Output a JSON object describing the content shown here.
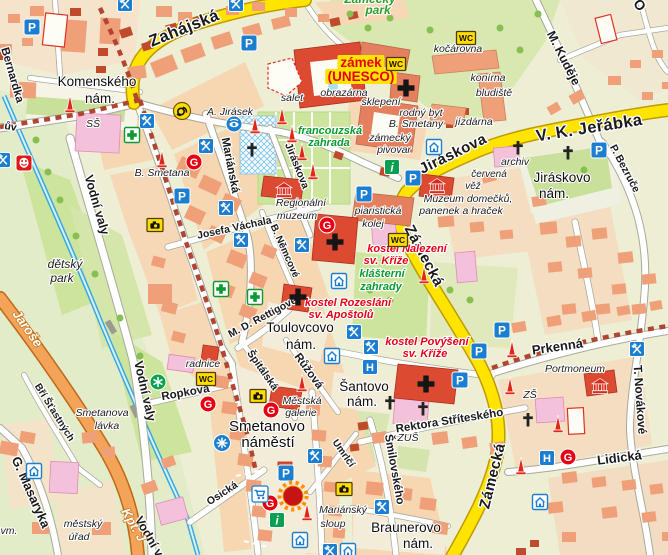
{
  "map": {
    "colors": {
      "land": "#edeed4",
      "park": "#cde49c",
      "park_bright": "#c9e09a",
      "square": "#f3ecd9",
      "block": "#f7d6b2",
      "block_pale": "#f4ddc0",
      "building": "#efa078",
      "building_dark": "#e5805e",
      "brick": "#bf4a2c",
      "landmark_red": "#dc4a32",
      "school_pink": "#f3c1d9",
      "road_major": "#ffe400",
      "road_major_casing": "#c09a00",
      "road_secondary": "#f4a458",
      "road_secondary_casing": "#c06818",
      "road_minor": "#ffffff",
      "road_minor_casing": "#a8a89c",
      "water": "#38a8e0",
      "historic_zone": "#b04632",
      "poi_blue": "#1b7ed0",
      "poi_red": "#e60012",
      "poi_green": "#0aa050",
      "poi_yellow": "#ffdc00",
      "castle_highlight": "#ffe400"
    },
    "icon_kinds": {
      "parking": {
        "name": "parking-icon",
        "glyph": "P"
      },
      "wc": {
        "name": "wc-icon",
        "glyph": "WC"
      },
      "restaurant": {
        "name": "restaurant-icon"
      },
      "pharmacy": {
        "name": "pharmacy-icon"
      },
      "hotel": {
        "name": "hotel-icon",
        "glyph": "H"
      },
      "pension": {
        "name": "guesthouse-icon"
      },
      "info": {
        "name": "information-icon",
        "glyph": "i"
      },
      "post": {
        "name": "post-office-icon"
      },
      "museum": {
        "name": "museum-icon"
      },
      "theater": {
        "name": "theatre-icon"
      },
      "gallery": {
        "name": "gallery-icon",
        "glyph": "G"
      },
      "monument": {
        "name": "monument-icon"
      },
      "church": {
        "name": "church-icon"
      },
      "cross": {
        "name": "cross-icon"
      },
      "camera": {
        "name": "camera-icon"
      },
      "star": {
        "name": "star-icon"
      },
      "fountain": {
        "name": "fountain-icon"
      },
      "cart": {
        "name": "supermarket-icon"
      },
      "sight": {
        "name": "sight-eye-icon"
      },
      "highlight": {
        "name": "landmark-highlight-icon"
      }
    },
    "labels": [
      {
        "t": "Zahájská",
        "x": 186,
        "y": 33,
        "r": -22,
        "c": "sm"
      },
      {
        "t": "V. K. Jeřábka",
        "x": 590,
        "y": 133,
        "r": -9,
        "c": "sm"
      },
      {
        "t": "Jiráskova",
        "x": 455,
        "y": 158,
        "r": -26,
        "c": "sm",
        "s": 15
      },
      {
        "t": "Zámecká",
        "x": 420,
        "y": 258,
        "r": 62,
        "c": "sm",
        "s": 15
      },
      {
        "t": "Zámecká",
        "x": 497,
        "y": 477,
        "r": -76,
        "c": "sm",
        "s": 15
      },
      {
        "t": "M. Kuděje",
        "x": 560,
        "y": 60,
        "r": 63,
        "c": "st",
        "s": 12.5
      },
      {
        "t": "P. Bezruče",
        "x": 622,
        "y": 170,
        "r": 62,
        "c": "st",
        "s": 10.5
      },
      {
        "t": "Mariánská",
        "x": 227,
        "y": 166,
        "r": 79,
        "c": "st"
      },
      {
        "t": "Jiráskova",
        "x": 294,
        "y": 167,
        "r": 68,
        "c": "st",
        "s": 10.5
      },
      {
        "t": "Vodní valy",
        "x": 93,
        "y": 206,
        "r": 74,
        "c": "st",
        "s": 12.5
      },
      {
        "t": "Vodní valy",
        "x": 141,
        "y": 392,
        "r": 77,
        "c": "st",
        "s": 12.5
      },
      {
        "t": "Vodní valy",
        "x": 150,
        "y": 546,
        "r": 60,
        "c": "st",
        "s": 12.5
      },
      {
        "t": "Josefa Váchala",
        "x": 235,
        "y": 231,
        "r": -12,
        "c": "st",
        "s": 10.5
      },
      {
        "t": "B. Němcové",
        "x": 282,
        "y": 252,
        "r": 66,
        "c": "st",
        "s": 10
      },
      {
        "t": "M. D. Rettigové",
        "x": 264,
        "y": 320,
        "r": -28,
        "c": "st",
        "s": 10.5
      },
      {
        "t": "Ropkova",
        "x": 186,
        "y": 396,
        "r": -10,
        "c": "st"
      },
      {
        "t": "Špitálská",
        "x": 260,
        "y": 372,
        "r": 55,
        "c": "st",
        "s": 10.5
      },
      {
        "t": "Růžová",
        "x": 306,
        "y": 373,
        "r": 54,
        "c": "st"
      },
      {
        "t": "Osická",
        "x": 224,
        "y": 496,
        "r": -33,
        "c": "st",
        "s": 10.5
      },
      {
        "t": "Umrlčí",
        "x": 341,
        "y": 455,
        "r": 55,
        "c": "st",
        "s": 10
      },
      {
        "t": "Šmilovského",
        "x": 391,
        "y": 470,
        "r": 80,
        "c": "st"
      },
      {
        "t": "Rektora Stříteského",
        "x": 450,
        "y": 424,
        "r": -9,
        "c": "st"
      },
      {
        "t": "Prkenná",
        "x": 558,
        "y": 351,
        "r": -8,
        "c": "st",
        "s": 13
      },
      {
        "t": "T. Novákové",
        "x": 636,
        "y": 400,
        "r": 86,
        "c": "st",
        "s": 12
      },
      {
        "t": "Lidická",
        "x": 620,
        "y": 462,
        "r": -7,
        "c": "st",
        "s": 13
      },
      {
        "t": "Bří Šťastných",
        "x": 52,
        "y": 414,
        "r": 58,
        "c": "st",
        "s": 10
      },
      {
        "t": "G. Masaryka",
        "x": 27,
        "y": 494,
        "r": 66,
        "c": "st",
        "s": 13
      },
      {
        "t": "Bernardka",
        "x": 9,
        "y": 76,
        "r": 74,
        "c": "st"
      },
      {
        "t": "ův",
        "x": 10,
        "y": 130,
        "r": 10,
        "c": "st",
        "s": 10.5
      },
      {
        "t": "O",
        "x": 636,
        "y": 8,
        "r": 50,
        "c": "st",
        "s": 14
      },
      {
        "t": "Jaroše",
        "x": 24,
        "y": 331,
        "r": 55,
        "c": "so"
      },
      {
        "t": "Kpt. J",
        "x": 130,
        "y": 527,
        "r": 60,
        "c": "so"
      },
      {
        "t": "Komenského",
        "x": 97,
        "y": 86,
        "r": 0,
        "c": "pl"
      },
      {
        "t": "nám.",
        "x": 100,
        "y": 103,
        "r": 0,
        "c": "pl"
      },
      {
        "t": "Toulovcovo",
        "x": 300,
        "y": 332,
        "r": 0,
        "c": "pl"
      },
      {
        "t": "nám.",
        "x": 301,
        "y": 349,
        "r": 0,
        "c": "pl"
      },
      {
        "t": "Šantovo",
        "x": 364,
        "y": 391,
        "r": 0,
        "c": "pl"
      },
      {
        "t": "nám.",
        "x": 362,
        "y": 406,
        "r": 0,
        "c": "pl"
      },
      {
        "t": "Smetanovo",
        "x": 267,
        "y": 431,
        "r": 0,
        "c": "pl",
        "s": 15
      },
      {
        "t": "náměstí",
        "x": 268,
        "y": 447,
        "r": 0,
        "c": "pl",
        "s": 15
      },
      {
        "t": "Braunerovo",
        "x": 406,
        "y": 532,
        "r": 0,
        "c": "pl"
      },
      {
        "t": "nám.",
        "x": 418,
        "y": 548,
        "r": 0,
        "c": "pl"
      },
      {
        "t": "Jiráskovo",
        "x": 562,
        "y": 182,
        "r": 0,
        "c": "pl"
      },
      {
        "t": "nám.",
        "x": 554,
        "y": 198,
        "r": 0,
        "c": "pl"
      },
      {
        "t": "SŠ",
        "x": 93,
        "y": 127,
        "r": 0,
        "c": "po"
      },
      {
        "t": "A. Jirásek",
        "x": 230,
        "y": 115,
        "r": 0,
        "c": "po"
      },
      {
        "t": "salet",
        "x": 292,
        "y": 101,
        "r": 0,
        "c": "po"
      },
      {
        "t": "obrazárna",
        "x": 344,
        "y": 96,
        "r": 0,
        "c": "po"
      },
      {
        "t": "sklepení",
        "x": 381,
        "y": 105,
        "r": 0,
        "c": "po"
      },
      {
        "t": "kočárovna",
        "x": 458,
        "y": 52,
        "r": 0,
        "c": "po"
      },
      {
        "t": "konírna",
        "x": 488,
        "y": 81,
        "r": 0,
        "c": "po"
      },
      {
        "t": "bludiště",
        "x": 494,
        "y": 96,
        "r": 0,
        "c": "po"
      },
      {
        "t": "rodný byt",
        "x": 421,
        "y": 116,
        "r": 0,
        "c": "po"
      },
      {
        "t": "B. Smetany",
        "x": 416,
        "y": 127,
        "r": 0,
        "c": "po"
      },
      {
        "t": "jízdárna",
        "x": 474,
        "y": 125,
        "r": 0,
        "c": "po"
      },
      {
        "t": "zámecký",
        "x": 390,
        "y": 141,
        "r": 0,
        "c": "po"
      },
      {
        "t": "pivovar",
        "x": 394,
        "y": 153,
        "r": 0,
        "c": "po"
      },
      {
        "t": "B. Smetana",
        "x": 162,
        "y": 176,
        "r": 0,
        "c": "po"
      },
      {
        "t": "dětský",
        "x": 65,
        "y": 268,
        "r": 0,
        "c": "po",
        "s": 12
      },
      {
        "t": "park",
        "x": 62,
        "y": 282,
        "r": 0,
        "c": "po",
        "s": 12
      },
      {
        "t": "Smetanova",
        "x": 102,
        "y": 416,
        "r": 0,
        "c": "po"
      },
      {
        "t": "lávka",
        "x": 107,
        "y": 429,
        "r": 0,
        "c": "po"
      },
      {
        "t": "městský",
        "x": 83,
        "y": 527,
        "r": 0,
        "c": "po"
      },
      {
        "t": "úřad",
        "x": 79,
        "y": 540,
        "r": 0,
        "c": "po"
      },
      {
        "t": "vm.",
        "x": 9,
        "y": 534,
        "r": 0,
        "c": "po"
      },
      {
        "t": "radnice",
        "x": 203,
        "y": 367,
        "r": 0,
        "c": "po"
      },
      {
        "t": "Městská",
        "x": 302,
        "y": 404,
        "r": 0,
        "c": "po"
      },
      {
        "t": "galerie",
        "x": 301,
        "y": 416,
        "r": 0,
        "c": "po"
      },
      {
        "t": "piaristická",
        "x": 378,
        "y": 214,
        "r": 0,
        "c": "po"
      },
      {
        "t": "kolej",
        "x": 373,
        "y": 227,
        "r": 0,
        "c": "po"
      },
      {
        "t": "Regionální",
        "x": 301,
        "y": 206,
        "r": 0,
        "c": "po"
      },
      {
        "t": "muzeum",
        "x": 297,
        "y": 219,
        "r": 0,
        "c": "po"
      },
      {
        "t": "archiv",
        "x": 515,
        "y": 165,
        "r": 0,
        "c": "po"
      },
      {
        "t": "červená",
        "x": 489,
        "y": 177,
        "r": 0,
        "c": "po",
        "s": 10
      },
      {
        "t": "věž",
        "x": 473,
        "y": 189,
        "r": 0,
        "c": "po",
        "s": 10
      },
      {
        "t": "Muzeum domečků,",
        "x": 468,
        "y": 202,
        "r": 0,
        "c": "po"
      },
      {
        "t": "panenek a hraček",
        "x": 461,
        "y": 214,
        "r": 0,
        "c": "po"
      },
      {
        "t": "Portmoneum",
        "x": 575,
        "y": 372,
        "r": 0,
        "c": "po"
      },
      {
        "t": "Mariánský",
        "x": 343,
        "y": 513,
        "r": 0,
        "c": "po"
      },
      {
        "t": "sloup",
        "x": 333,
        "y": 527,
        "r": 0,
        "c": "po"
      },
      {
        "t": "ZUŠ",
        "x": 408,
        "y": 441,
        "r": 0,
        "c": "po"
      },
      {
        "t": "ZŠ",
        "x": 530,
        "y": 398,
        "r": 0,
        "c": "po"
      },
      {
        "t": "Zámecký",
        "x": 370,
        "y": 3,
        "r": 0,
        "c": "pk"
      },
      {
        "t": "park",
        "x": 378,
        "y": 14,
        "r": 0,
        "c": "pk"
      },
      {
        "t": "zámek",
        "x": 361,
        "y": 67,
        "r": 0,
        "c": "hl"
      },
      {
        "t": "(UNESCO)",
        "x": 361,
        "y": 81,
        "r": 0,
        "c": "hl"
      },
      {
        "t": "kostel Nalezení",
        "x": 407,
        "y": 252,
        "r": 0,
        "c": "rd"
      },
      {
        "t": "sv. Kříže",
        "x": 386,
        "y": 264,
        "r": 0,
        "c": "rd"
      },
      {
        "t": "klášterní",
        "x": 382,
        "y": 277,
        "r": 0,
        "c": "gr"
      },
      {
        "t": "zahrady",
        "x": 381,
        "y": 290,
        "r": 0,
        "c": "gr"
      },
      {
        "t": "kostel Rozeslání",
        "x": 348,
        "y": 306,
        "r": 0,
        "c": "rd"
      },
      {
        "t": "sv. Apoštolů",
        "x": 341,
        "y": 318,
        "r": 0,
        "c": "rd"
      },
      {
        "t": "kostel Povýšení",
        "x": 427,
        "y": 345,
        "r": 0,
        "c": "rd"
      },
      {
        "t": "sv. Kříže",
        "x": 425,
        "y": 357,
        "r": 0,
        "c": "rd"
      },
      {
        "t": "francouzská",
        "x": 330,
        "y": 134,
        "r": 0,
        "c": "gr"
      },
      {
        "t": "zahrada",
        "x": 329,
        "y": 146,
        "r": 0,
        "c": "gr"
      }
    ],
    "pois": [
      {
        "k": "parking",
        "x": 32,
        "y": 27
      },
      {
        "k": "parking",
        "x": 249,
        "y": 43
      },
      {
        "k": "parking",
        "x": 599,
        "y": 150
      },
      {
        "k": "parking",
        "x": 413,
        "y": 178
      },
      {
        "k": "parking",
        "x": 364,
        "y": 194
      },
      {
        "k": "parking",
        "x": 182,
        "y": 196
      },
      {
        "k": "parking",
        "x": 502,
        "y": 330
      },
      {
        "k": "parking",
        "x": 479,
        "y": 351
      },
      {
        "k": "parking",
        "x": 460,
        "y": 380
      },
      {
        "k": "parking",
        "x": 286,
        "y": 473
      },
      {
        "k": "wc",
        "x": 466,
        "y": 38
      },
      {
        "k": "wc",
        "x": 396,
        "y": 64
      },
      {
        "k": "wc",
        "x": 398,
        "y": 240
      },
      {
        "k": "wc",
        "x": 206,
        "y": 379
      },
      {
        "k": "restaurant",
        "x": 125,
        "y": 4
      },
      {
        "k": "restaurant",
        "x": 236,
        "y": 4
      },
      {
        "k": "restaurant",
        "x": 3,
        "y": 160
      },
      {
        "k": "restaurant",
        "x": 147,
        "y": 121
      },
      {
        "k": "restaurant",
        "x": 206,
        "y": 146
      },
      {
        "k": "restaurant",
        "x": 226,
        "y": 208
      },
      {
        "k": "restaurant",
        "x": 241,
        "y": 240
      },
      {
        "k": "restaurant",
        "x": 302,
        "y": 245
      },
      {
        "k": "restaurant",
        "x": 354,
        "y": 332
      },
      {
        "k": "restaurant",
        "x": 371,
        "y": 347
      },
      {
        "k": "restaurant",
        "x": 637,
        "y": 349
      },
      {
        "k": "restaurant",
        "x": 315,
        "y": 456
      },
      {
        "k": "restaurant",
        "x": 382,
        "y": 507
      },
      {
        "k": "restaurant",
        "x": 330,
        "y": 551
      },
      {
        "k": "pharmacy",
        "x": 132,
        "y": 135
      },
      {
        "k": "pharmacy",
        "x": 221,
        "y": 289
      },
      {
        "k": "pharmacy",
        "x": 255,
        "y": 297
      },
      {
        "k": "hotel",
        "x": 370,
        "y": 367
      },
      {
        "k": "hotel",
        "x": 547,
        "y": 458
      },
      {
        "k": "pension",
        "x": 434,
        "y": 147
      },
      {
        "k": "pension",
        "x": 339,
        "y": 281
      },
      {
        "k": "pension",
        "x": 332,
        "y": 356
      },
      {
        "k": "pension",
        "x": 34,
        "y": 471
      },
      {
        "k": "pension",
        "x": 540,
        "y": 502
      },
      {
        "k": "pension",
        "x": 300,
        "y": 540
      },
      {
        "k": "pension",
        "x": 348,
        "y": 551
      },
      {
        "k": "info",
        "x": 392,
        "y": 167
      },
      {
        "k": "info",
        "x": 277,
        "y": 520
      },
      {
        "k": "post",
        "x": 182,
        "y": 111
      },
      {
        "k": "museum",
        "x": 284,
        "y": 190
      },
      {
        "k": "museum",
        "x": 437,
        "y": 186
      },
      {
        "k": "museum",
        "x": 600,
        "y": 386
      },
      {
        "k": "theater",
        "x": 24,
        "y": 163
      },
      {
        "k": "gallery",
        "x": 194,
        "y": 162
      },
      {
        "k": "gallery",
        "x": 327,
        "y": 225
      },
      {
        "k": "gallery",
        "x": 208,
        "y": 404
      },
      {
        "k": "gallery",
        "x": 271,
        "y": 410
      },
      {
        "k": "gallery",
        "x": 270,
        "y": 503
      },
      {
        "k": "gallery",
        "x": 568,
        "y": 457
      },
      {
        "k": "monument",
        "x": 70,
        "y": 104
      },
      {
        "k": "monument",
        "x": 162,
        "y": 159
      },
      {
        "k": "monument",
        "x": 255,
        "y": 125
      },
      {
        "k": "monument",
        "x": 282,
        "y": 116
      },
      {
        "k": "monument",
        "x": 292,
        "y": 134
      },
      {
        "k": "monument",
        "x": 302,
        "y": 152
      },
      {
        "k": "monument",
        "x": 313,
        "y": 171
      },
      {
        "k": "monument",
        "x": 424,
        "y": 275
      },
      {
        "k": "monument",
        "x": 302,
        "y": 383
      },
      {
        "k": "monument",
        "x": 307,
        "y": 512
      },
      {
        "k": "monument",
        "x": 512,
        "y": 349
      },
      {
        "k": "monument",
        "x": 510,
        "y": 386
      },
      {
        "k": "monument",
        "x": 558,
        "y": 424
      },
      {
        "k": "monument",
        "x": 521,
        "y": 466
      },
      {
        "k": "church",
        "x": 406,
        "y": 88
      },
      {
        "k": "church",
        "x": 335,
        "y": 242
      },
      {
        "k": "church",
        "x": 298,
        "y": 297
      },
      {
        "k": "church",
        "x": 426,
        "y": 384
      },
      {
        "k": "cross",
        "x": 252,
        "y": 150
      },
      {
        "k": "cross",
        "x": 518,
        "y": 148
      },
      {
        "k": "cross",
        "x": 568,
        "y": 153
      },
      {
        "k": "cross",
        "x": 390,
        "y": 403
      },
      {
        "k": "cross",
        "x": 423,
        "y": 409
      },
      {
        "k": "cross",
        "x": 528,
        "y": 420
      },
      {
        "k": "camera",
        "x": 155,
        "y": 225
      },
      {
        "k": "camera",
        "x": 258,
        "y": 396
      },
      {
        "k": "camera",
        "x": 344,
        "y": 489
      },
      {
        "k": "star",
        "x": 158,
        "y": 382
      },
      {
        "k": "fountain",
        "x": 222,
        "y": 443
      },
      {
        "k": "cart",
        "x": 260,
        "y": 494
      },
      {
        "k": "sight",
        "x": 234,
        "y": 124
      },
      {
        "k": "highlight",
        "x": 293,
        "y": 496
      }
    ]
  }
}
